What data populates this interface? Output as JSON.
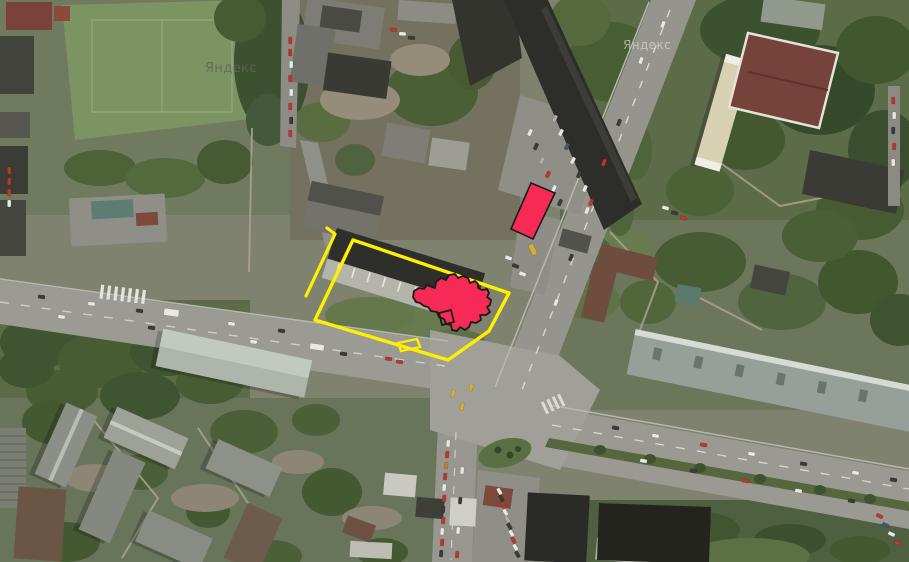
{
  "map": {
    "watermarks": [
      {
        "text": "Яндекс"
      },
      {
        "text": "Яндекс"
      }
    ]
  },
  "annotations": {
    "accent_yellow": "#fdf000",
    "accent_red": "#f72a56",
    "outline_black": "#1a1a1a",
    "boundary_segment": {
      "points": [
        [
          327,
          228
        ],
        [
          335,
          234
        ],
        [
          306,
          296
        ]
      ]
    },
    "boundary_polygon": {
      "points": [
        [
          353,
          240
        ],
        [
          509,
          293
        ],
        [
          489,
          331
        ],
        [
          448,
          360
        ],
        [
          315,
          320
        ]
      ]
    },
    "boundary_notch": {
      "points": [
        [
          398,
          343
        ],
        [
          417,
          339
        ],
        [
          420,
          347
        ],
        [
          401,
          351
        ]
      ]
    },
    "marker_rectangle": {
      "points": [
        [
          531,
          183
        ],
        [
          555,
          193
        ],
        [
          533,
          239
        ],
        [
          511,
          229
        ]
      ]
    },
    "highlighted_building": {
      "path": "M413,297 L414,291 419,288 424,289 427,285 432,287 435,288 436,282 441,278 446,280 449,275 455,274 458,278 463,276 468,278 470,283 475,281 478,284 478,288 482,290 487,289 489,293 487,297 491,300 490,305 487,307 490,312 486,315 480,315 481,320 476,323 471,322 469,327 465,330 460,327 457,331 452,330 451,325 446,324 444,319 439,317 437,312 431,311 428,307 424,306 420,303 416,302 Z"
    },
    "building_tab": {
      "points": [
        [
          439,
          313
        ],
        [
          451,
          310
        ],
        [
          454,
          322
        ],
        [
          442,
          325
        ]
      ]
    }
  }
}
